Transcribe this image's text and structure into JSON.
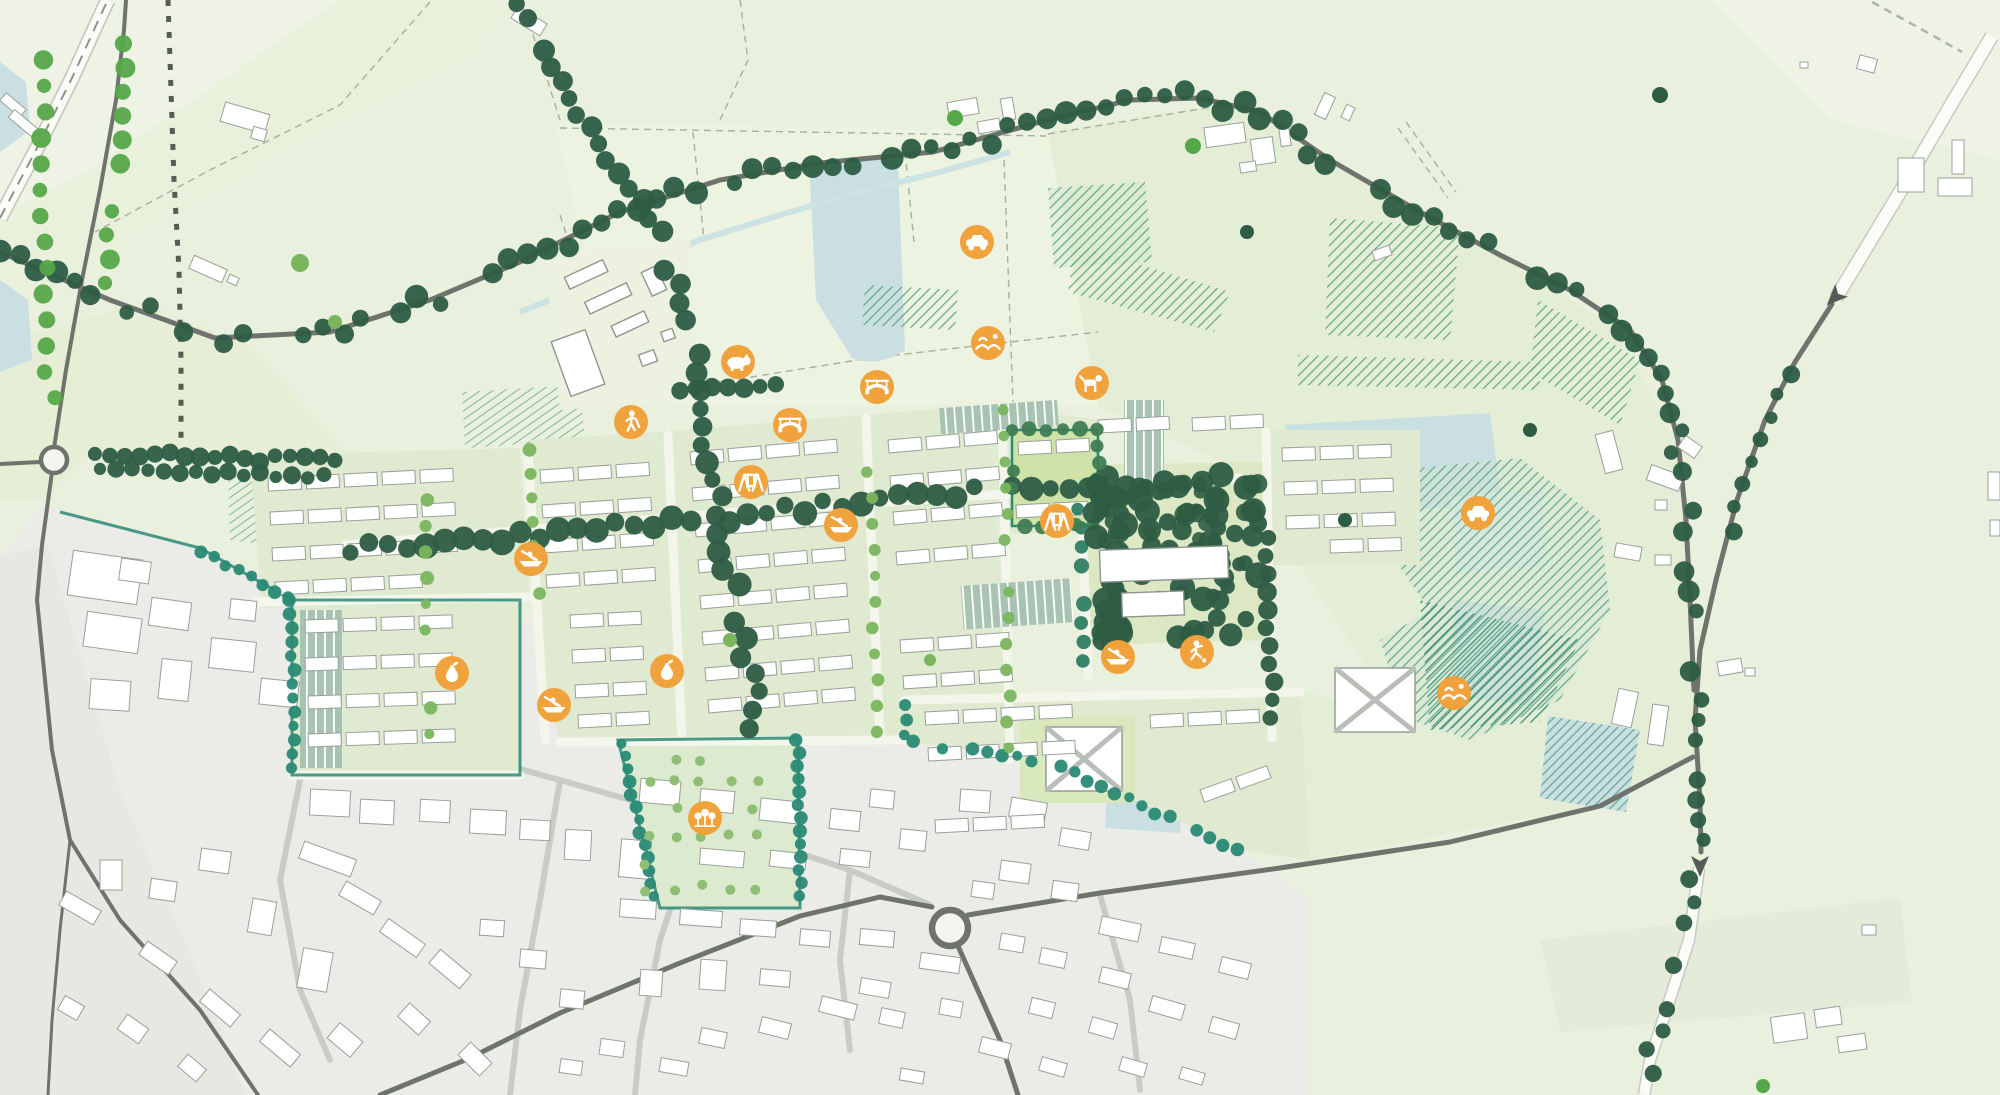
{
  "map": {
    "kind": "illustrative-masterplan-map",
    "visible_text": [],
    "colors": {
      "field_light": "#eaf0de",
      "field_mid": "#e4edd6",
      "field_pale": "#eef3e6",
      "field_band": "#edf3e1",
      "parcel_green": "#e0ead0",
      "lawn": "#cfe3a9",
      "town_grey": "#ebece8",
      "town_grey_warm": "#e7e8e1",
      "building_white": "#ffffff",
      "building_outline": "#98a099",
      "road_grey": "#6e736c",
      "road_white": "#fbfcf8",
      "road_border": "#c6cabf",
      "tree_dark": "#2d5c43",
      "tree_teal": "#2a8a74",
      "tree_teal_dark": "#2f7d63",
      "tree_bright": "#56a749",
      "tree_light": "#7ab55e",
      "orchard_tree": "#8fbe74",
      "woodland_hatch": "#5fa983",
      "woodland_hatch_dark": "#3f9076",
      "water": "#c9dfe1",
      "water_pale": "#d8e8e6",
      "parking_fill": "#a9c3b2",
      "icon_orange": "#f0a23c",
      "icon_glyph": "#ffffff",
      "footpath_dash": "#565b54"
    },
    "amenity_icons": [
      {
        "name": "pig-paddock",
        "glyph": "pig",
        "x": 738,
        "y": 362
      },
      {
        "name": "car-access",
        "glyph": "car",
        "x": 977,
        "y": 242
      },
      {
        "name": "landscape-mounds",
        "glyph": "hills",
        "x": 988,
        "y": 343
      },
      {
        "name": "dog-walking",
        "glyph": "dog",
        "x": 1092,
        "y": 383
      },
      {
        "name": "bridge-crossing-north",
        "glyph": "bridge",
        "x": 877,
        "y": 387
      },
      {
        "name": "bridge-crossing-west",
        "glyph": "bridge",
        "x": 790,
        "y": 425
      },
      {
        "name": "golf-walking",
        "glyph": "golfer",
        "x": 631,
        "y": 422
      },
      {
        "name": "play-swings-west",
        "glyph": "swings",
        "x": 751,
        "y": 482
      },
      {
        "name": "boating-west",
        "glyph": "boat",
        "x": 841,
        "y": 525
      },
      {
        "name": "play-swings-east",
        "glyph": "swings",
        "x": 1057,
        "y": 521
      },
      {
        "name": "boating-southwest",
        "glyph": "boat",
        "x": 531,
        "y": 559
      },
      {
        "name": "orchard-fruit-west",
        "glyph": "pear",
        "x": 452,
        "y": 673
      },
      {
        "name": "boating-south",
        "glyph": "boat",
        "x": 554,
        "y": 705
      },
      {
        "name": "orchard-fruit-east",
        "glyph": "pear",
        "x": 667,
        "y": 671
      },
      {
        "name": "sports-play",
        "glyph": "runner",
        "x": 1197,
        "y": 652
      },
      {
        "name": "boating-southeast",
        "glyph": "boat",
        "x": 1118,
        "y": 657
      },
      {
        "name": "community-orchard",
        "glyph": "trees",
        "x": 705,
        "y": 818
      },
      {
        "name": "car-access-east",
        "glyph": "car",
        "x": 1478,
        "y": 513
      },
      {
        "name": "landscape-mounds-east",
        "glyph": "hills",
        "x": 1454,
        "y": 693
      }
    ],
    "roundabouts": [
      {
        "name": "roundabout-west",
        "x": 54,
        "y": 460,
        "r": 13
      },
      {
        "name": "roundabout-town",
        "x": 950,
        "y": 928,
        "r": 18
      }
    ],
    "direction_arrows": [
      {
        "name": "arrow-northeast-road",
        "x": 1836,
        "y": 296,
        "angle": 225
      },
      {
        "name": "arrow-south-road",
        "x": 1700,
        "y": 864,
        "angle": 180
      }
    ],
    "water_bodies": [
      {
        "name": "pond-north",
        "cx": 855,
        "cy": 258
      },
      {
        "name": "lake-east",
        "cx": 1395,
        "cy": 465
      },
      {
        "name": "pond-east-square",
        "cx": 1495,
        "cy": 530
      },
      {
        "name": "pond-southeast",
        "cx": 1497,
        "cy": 652
      },
      {
        "name": "lake-far-southeast",
        "cx": 1588,
        "cy": 760
      },
      {
        "name": "pond-school",
        "cx": 1146,
        "cy": 798
      },
      {
        "name": "lake-west-edge-upper",
        "cx": 12,
        "cy": 105
      },
      {
        "name": "lake-west-edge-lower",
        "cx": 14,
        "cy": 322
      }
    ]
  }
}
